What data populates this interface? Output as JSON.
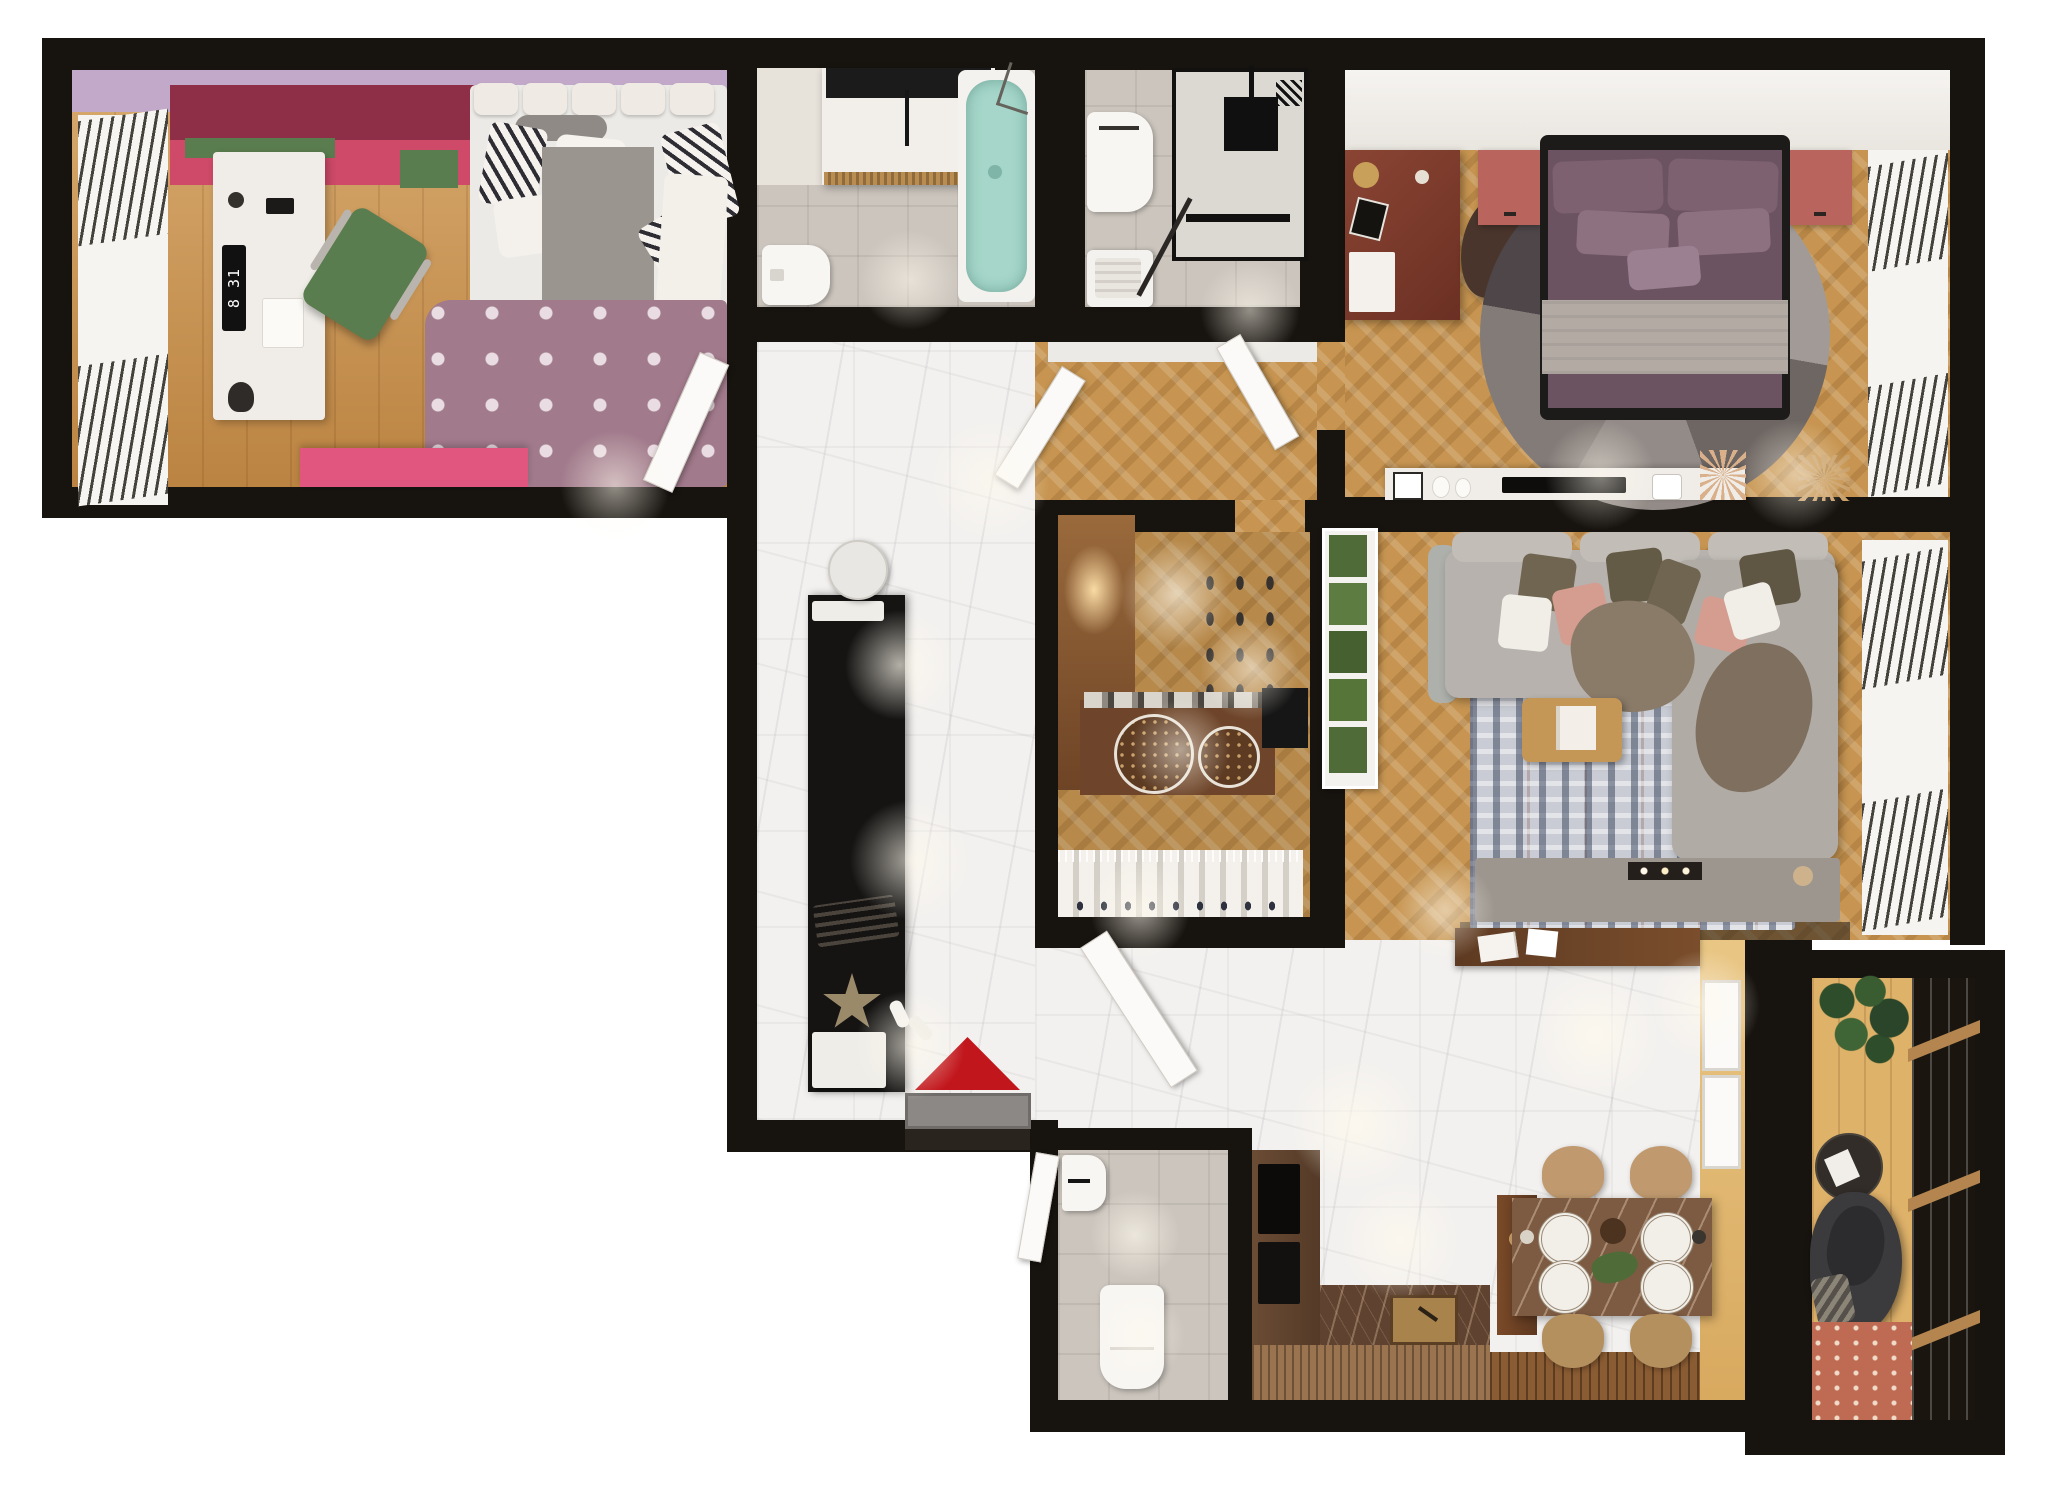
{
  "kids_room": {
    "clock_display": "8 31"
  },
  "dining": {
    "place_settings": 4,
    "chairs": 4
  },
  "palette": {
    "wall": "#17130f",
    "wood_kids": "#c8914c",
    "herringbone": "#c79551",
    "marble": "#f3f1ef",
    "tile": "#cbc5bd",
    "lavender": "#c2a8c9",
    "pink_dark": "#8e2f47",
    "pink": "#c2405f",
    "pink_bright": "#e0567e",
    "green_accent": "#5a7d4f",
    "desk_white": "#f0ede8",
    "clock_black": "#111111",
    "rug_polka": "#a17a8b",
    "teal_tub": "#a5d6c9",
    "mauve_bed": "#6b5362",
    "grey_blanket": "#b3aaa3",
    "terracotta": "#b9655d",
    "bed_frame": "#1d1a1a",
    "desk_mahogany": "#7c3a2a",
    "sofa_grey": "#b7b2ad",
    "pillow_pink": "#d59c90",
    "pillow_olive": "#6f6550",
    "throw_brown": "#8a7a68",
    "rug_living_base": "#c9ccd4",
    "rug_living_navy": "#39455e",
    "coffee_table": "#c49757",
    "tv_console": "#9d968f",
    "plant_green": "#4e6b38",
    "closet_wood": "#8a5a33",
    "console_wood": "#6e452a",
    "basket_brown": "#5d3a22",
    "kitchen_marble": "#5f4230",
    "kitchen_rib": "#9a7450",
    "gold_sink": "#a8834c",
    "dining_stone": "#7d5b42",
    "chair_tan": "#c09a6e",
    "balcony_floor": "#dfb26a",
    "egg_chair": "#3b3b3e",
    "balcony_rug": "#bf6a52",
    "red_triangle": "#c1161c",
    "beige_wall": "#e3bc79",
    "doormat_grey": "#8b8886"
  },
  "scene": {
    "type": "apartment-floor-plan-top-view",
    "rooms": [
      {
        "name": "kids-bedroom",
        "furniture": [
          "pink-wardrobe",
          "white-desk",
          "digital-clock",
          "green-desk-chair",
          "single-bed",
          "polka-dot-rug",
          "pink-storage-bench",
          "window-blinds"
        ]
      },
      {
        "name": "bathroom",
        "furniture": [
          "vanity-sink",
          "teal-bathtub",
          "toilet",
          "marble-counter"
        ]
      },
      {
        "name": "laundry-bathroom",
        "furniture": [
          "toilet",
          "washing-machine",
          "shower-cabin"
        ]
      },
      {
        "name": "master-bedroom",
        "furniture": [
          "double-bed",
          "nightstand-left",
          "nightstand-right",
          "round-rug",
          "mahogany-desk",
          "desk-chair",
          "media-console",
          "window-blinds"
        ]
      },
      {
        "name": "living-room",
        "furniture": [
          "corner-sofa",
          "abstract-rug",
          "coffee-table",
          "tv-console",
          "fireplace",
          "vertical-garden",
          "window-blinds",
          "wood-bench"
        ]
      },
      {
        "name": "walk-in-closet",
        "furniture": [
          "wood-cabinet",
          "shoe-rack",
          "console-with-baskets",
          "clothes-rail"
        ]
      },
      {
        "name": "hallway",
        "furniture": [
          "black-wardrobe-unit",
          "round-mirror",
          "bench",
          "doormat",
          "red-triangle-decor",
          "star-decor"
        ]
      },
      {
        "name": "wc",
        "furniture": [
          "toilet",
          "wall-sink"
        ]
      },
      {
        "name": "kitchen",
        "furniture": [
          "tall-cabinet-appliances",
          "stone-counter",
          "gold-sink",
          "ribbed-bar-front",
          "deck-strip"
        ]
      },
      {
        "name": "dining-area",
        "furniture": [
          "stone-dining-table",
          "dining-chairs",
          "window-sashes",
          "wood-console"
        ]
      },
      {
        "name": "balcony",
        "furniture": [
          "potted-plant",
          "round-side-table",
          "egg-chair",
          "outdoor-rug",
          "glazed-window-wall"
        ]
      }
    ]
  }
}
